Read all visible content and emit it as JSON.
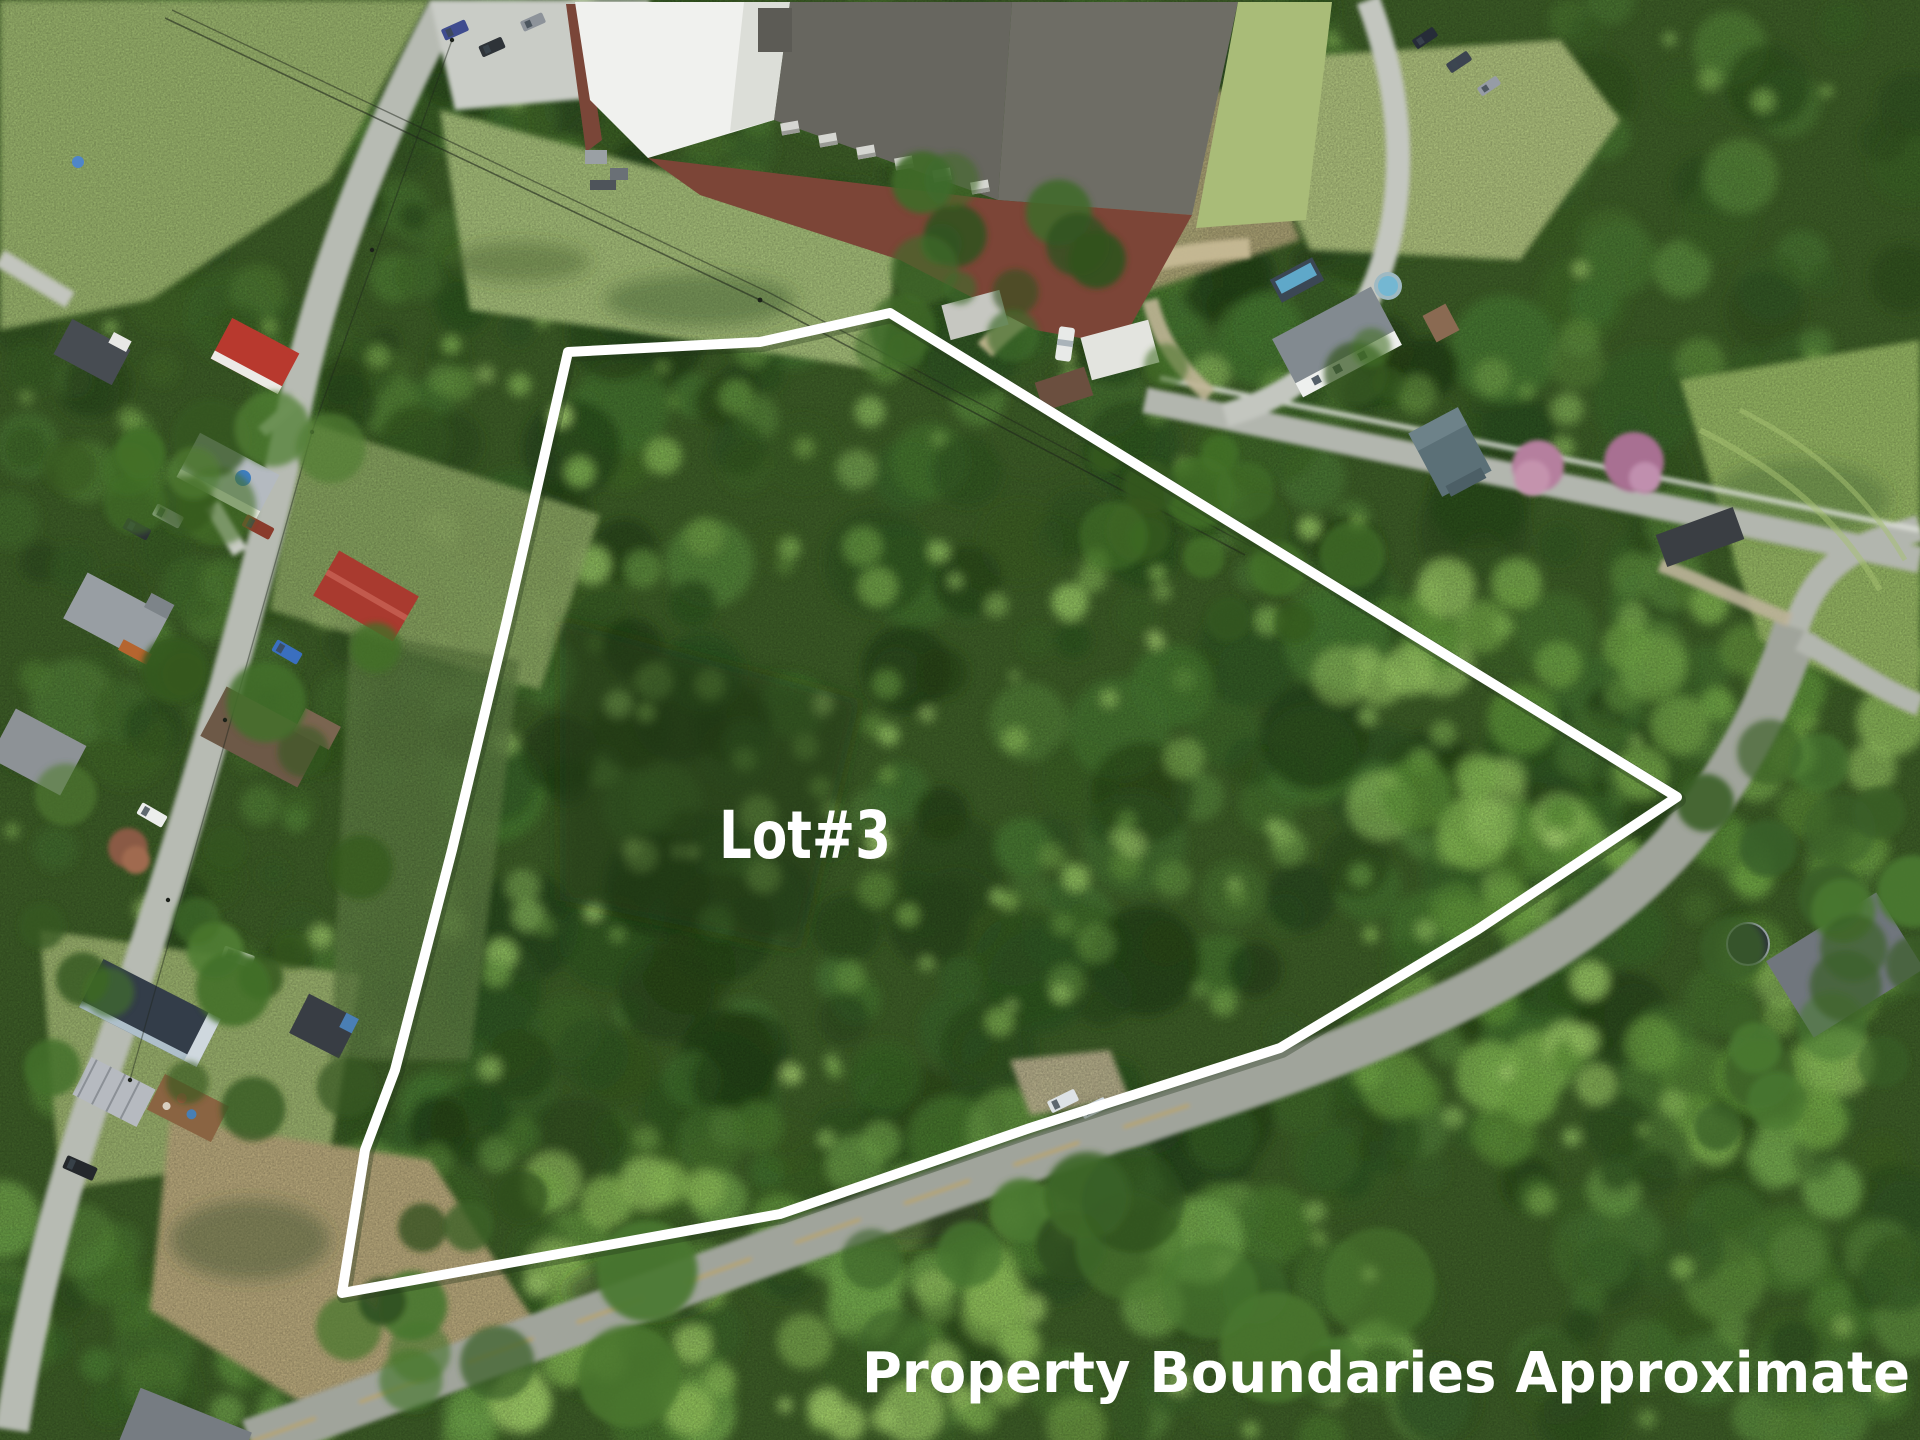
{
  "image": {
    "kind": "aerial-drone-real-estate-photo",
    "width": 1920,
    "height": 1440
  },
  "overlay": {
    "lot_label": "Lot#3",
    "disclaimer": "Property Boundaries Approximate",
    "text_color": "#ffffff",
    "boundary": {
      "points": "568,352 760,342 890,313 1677,797 1477,930 1280,1048 1030,1128 780,1214 342,1293 365,1150 395,1070 452,850 507,620",
      "stroke_color": "#ffffff",
      "stroke_width": 10
    }
  },
  "scene": {
    "features": [
      "wooded-vacant-lot",
      "industrial-building",
      "residential-street-left",
      "main-road-bottom",
      "street-top-right",
      "houses",
      "vehicles",
      "power-lines",
      "lawns",
      "dry-grass-field"
    ],
    "palette": {
      "canopy_dark": "#27441a",
      "canopy_mid": "#3e6526",
      "canopy_light": "#6fa344",
      "lawn_green": "#9db573",
      "dry_grass": "#b0a176",
      "road_gray": "#a8aca3",
      "factory_roof_dark": "#6a6962",
      "factory_roof_white": "#f0f1ee",
      "brick_wall": "#7c4537",
      "red_roof": "#b8392e",
      "navy_roof": "#333d49",
      "boundary_white": "#ffffff",
      "center_line_yellow": "#c7a43e"
    }
  }
}
